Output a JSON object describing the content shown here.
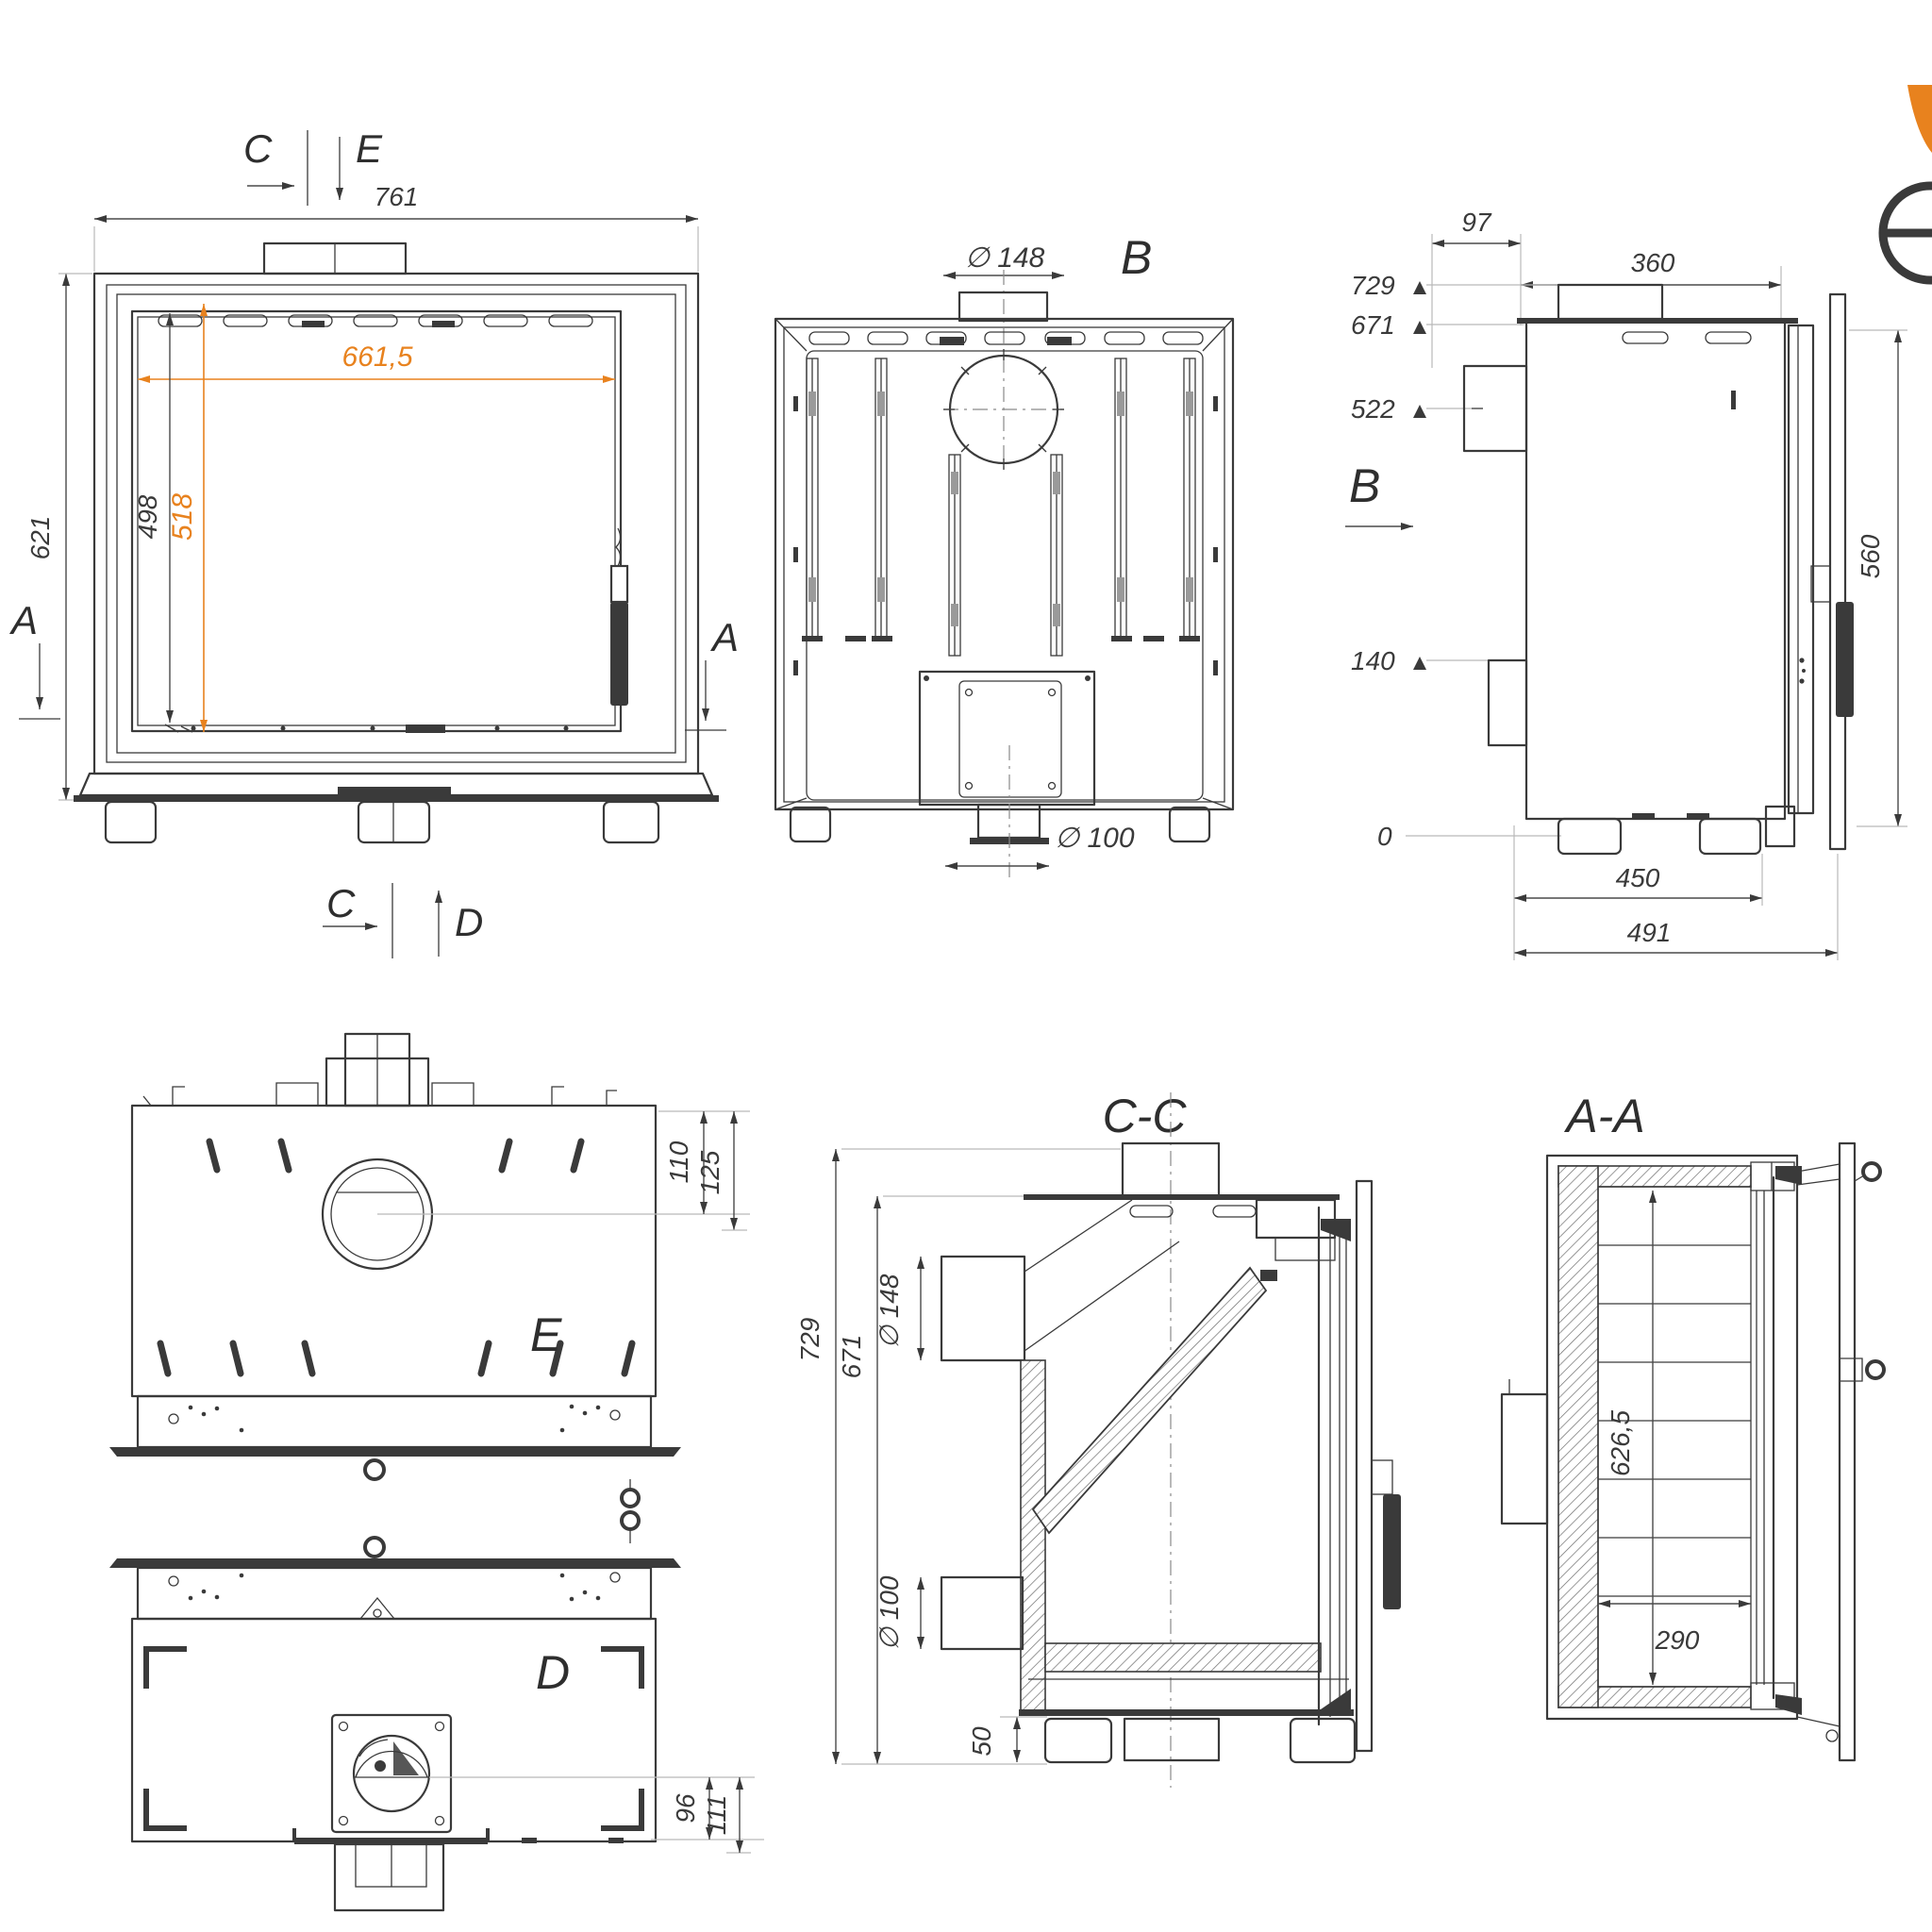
{
  "drawing_type": "fireplace-insert technical drawing, multi-view with sections",
  "colors": {
    "line": "#3a3a3a",
    "accent_orange": "#E8821E",
    "leader": "#b9b9b9",
    "background": "#ffffff"
  },
  "logo": {
    "description": "partial brand logo, orange petal and circle with horizontal bar",
    "orange": "#E8821E"
  },
  "views": {
    "front": {
      "section_marker_top_c": "C",
      "section_marker_top_e": "E",
      "dim_overall_width": "761",
      "dim_overall_height": "621",
      "dim_glass_width": "661,5",
      "dim_opening_height": "498",
      "dim_glass_height": "518",
      "section_marker_left_a": "A",
      "section_marker_right_a": "A",
      "section_marker_bottom_c": "C",
      "section_marker_bottom_d": "D"
    },
    "rear": {
      "label": "B",
      "dim_flue_diameter": "∅ 148",
      "dim_air_inlet_diameter": "∅ 100"
    },
    "side": {
      "label": "B",
      "dim_rear_offset": "97",
      "dim_top_depth": "360",
      "level_729": "729",
      "level_671": "671",
      "level_522": "522",
      "level_140": "140",
      "level_0": "0",
      "dim_door_height": "560",
      "dim_depth_body": "450",
      "dim_depth_total": "491"
    },
    "top_e": {
      "label": "E",
      "dim_110": "110",
      "dim_125": "125"
    },
    "bottom_d": {
      "label": "D",
      "dim_96": "96",
      "dim_111": "111"
    },
    "section_cc": {
      "label": "C-C",
      "dim_height_total": "729",
      "dim_height_body": "671",
      "dim_flue_diameter": "∅ 148",
      "dim_air_inlet_diameter": "∅ 100",
      "dim_foot_height": "50"
    },
    "section_aa": {
      "label": "A-A",
      "dim_interior_height": "626,5",
      "dim_interior_width": "290"
    }
  }
}
